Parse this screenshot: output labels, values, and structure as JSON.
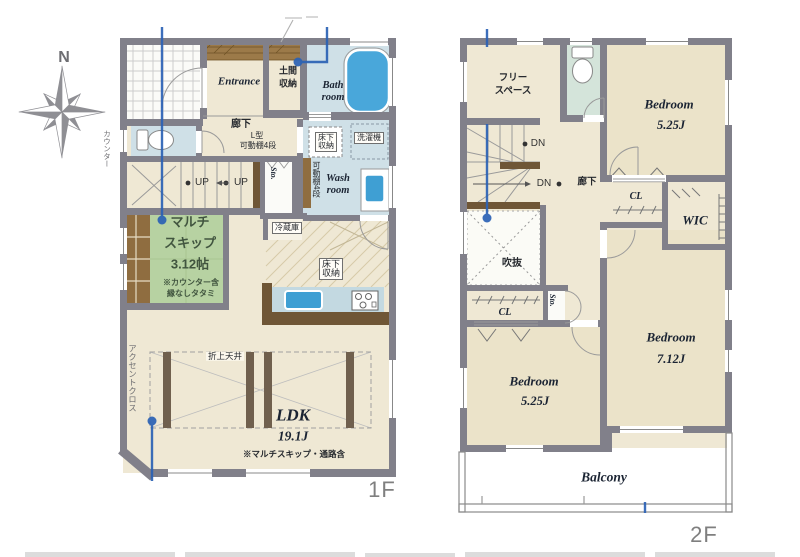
{
  "compass": {
    "north": "N"
  },
  "floor1": {
    "floor_label": "1F",
    "entrance": "Entrance",
    "doma_l1": "土間",
    "doma_l2": "収納",
    "bath_l1": "Bath",
    "bath_l2": "room",
    "hall": "廊下",
    "hall_sub1": "L型",
    "hall_sub2": "可動棚4段",
    "underfloor1_l1": "床下",
    "underfloor1_l2": "収納",
    "washer": "洗濯機",
    "wash_l1": "Wash",
    "wash_l2": "room",
    "shelf4": "可動棚4段",
    "sto": "Sto.",
    "up1": "UP",
    "up2": "UP",
    "counter_note": "カウンター",
    "multi_l1": "マルチ",
    "multi_l2": "スキップ",
    "multi_l3": "3.12帖",
    "multi_note1": "※カウンター含",
    "multi_note2": "縁なしタタミ",
    "fridge": "冷蔵庫",
    "underfloor2_l1": "床下",
    "underfloor2_l2": "収納",
    "ceiling": "折上天井",
    "ldk": "LDK",
    "ldk_size": "19.1J",
    "ldk_note": "※マルチスキップ・通路含",
    "accent": "アクセントクロス"
  },
  "floor2": {
    "floor_label": "2F",
    "free_l1": "フリー",
    "free_l2": "スペース",
    "bedroom1": "Bedroom",
    "bedroom1_size": "5.25J",
    "dn1": "DN",
    "dn2": "DN",
    "hall": "廊下",
    "cl1": "CL",
    "wic": "WIC",
    "void": "吹抜",
    "cl2": "CL",
    "sto": "Sto.",
    "bedroom2": "Bedroom",
    "bedroom2_size": "5.25J",
    "bedroom3": "Bedroom",
    "bedroom3_size": "7.12J",
    "balcony": "Balcony"
  },
  "colors": {
    "wall": "#81808a",
    "floor_cream": "#efe8d4",
    "bedroom_floor": "#ebe3c9",
    "wet_floor": "#cfe0e7",
    "toilet2_floor": "#d4e4da",
    "tatami_green": "#b7d2a2",
    "water_blue": "#49a7da",
    "wood": "#8f6d40",
    "counter_wood": "#6f5636",
    "annotation_blue": "#2b62b5"
  }
}
